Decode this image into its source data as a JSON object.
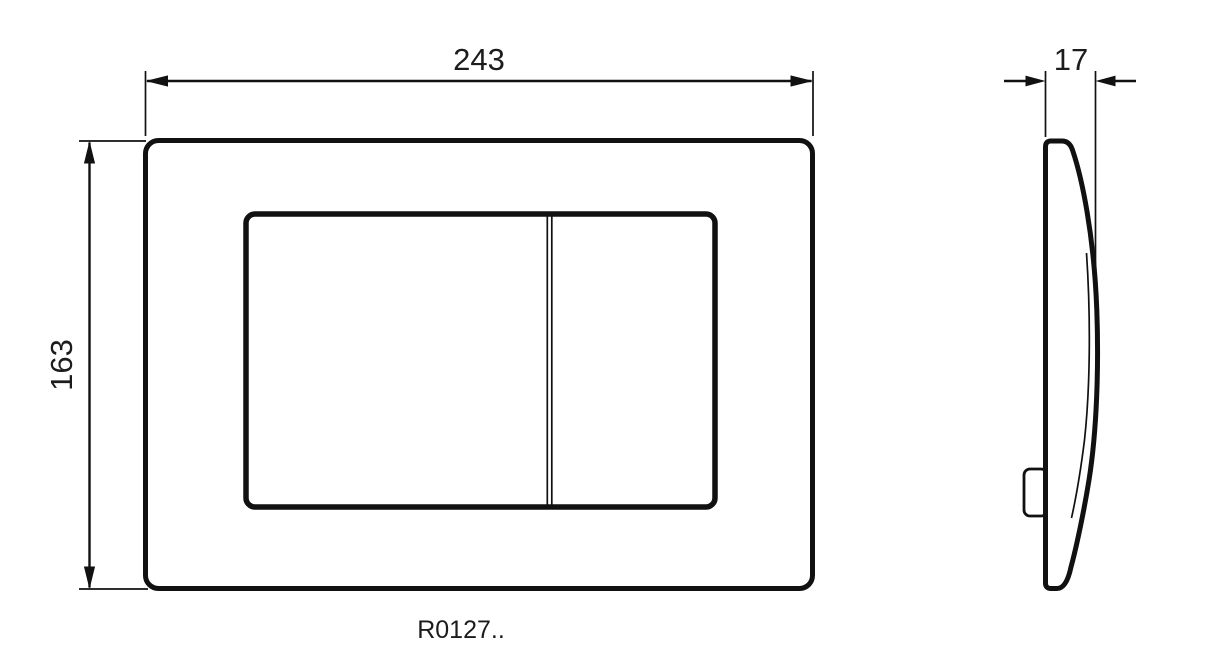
{
  "drawing": {
    "dimensions": {
      "front_width": "243",
      "front_height": "163",
      "side_depth": "17"
    },
    "product_code": "R0127..",
    "colors": {
      "line": "#111111",
      "text": "#1c1c1c",
      "background": "#ffffff"
    }
  }
}
